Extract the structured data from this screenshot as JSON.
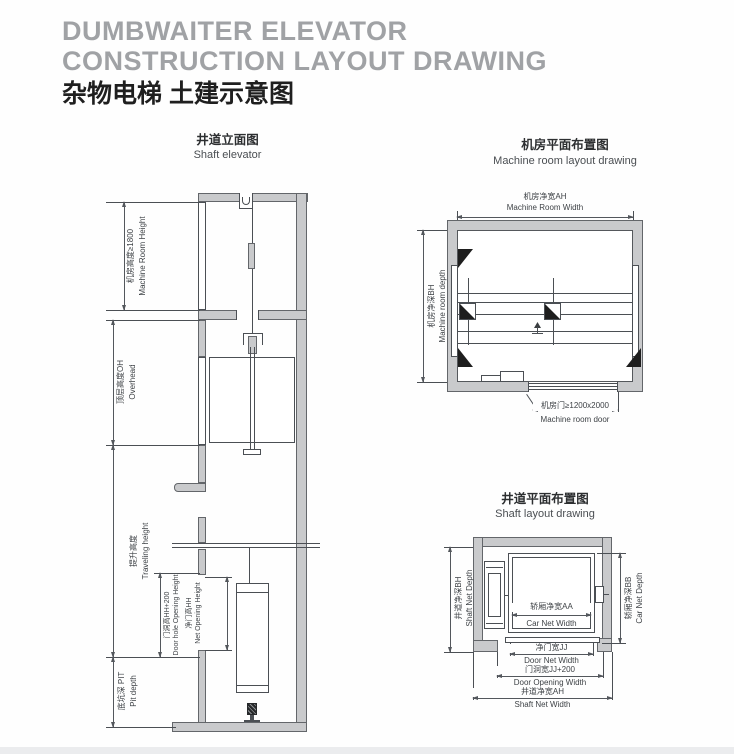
{
  "header": {
    "title_en_line1": "DUMBWAITER ELEVATOR",
    "title_en_line2": "CONSTRUCTION LAYOUT DRAWING",
    "title_cn": "杂物电梯 土建示意图"
  },
  "shaft_elevation": {
    "title_cn": "井道立面图",
    "title_en": "Shaft elevator",
    "dims": {
      "machine_room_height": {
        "cn": "机房高度≥1800",
        "en": "Machine Room Height"
      },
      "overhead": {
        "cn": "顶层高度OH",
        "en": "Overhead"
      },
      "traveling_height": {
        "cn": "提升高度",
        "en": "Traveling height"
      },
      "door_opening_height": {
        "cn": "门洞高HH+200",
        "en": "Door hole Opening Height"
      },
      "net_opening_height": {
        "cn": "净门高HH",
        "en": "Net Opening Height"
      },
      "pit_depth": {
        "cn": "底坑深 PIT",
        "en": "Pit depth"
      }
    }
  },
  "machine_room_plan": {
    "title_cn": "机房平面布置图",
    "title_en": "Machine room layout drawing",
    "dims": {
      "width": {
        "cn": "机房净宽AH",
        "en": "Machine Room Width"
      },
      "depth": {
        "cn": "机房净深BH",
        "en": "Machine room depth"
      },
      "door": {
        "cn": "机房门≥1200x2000",
        "en": "Machine room door"
      }
    }
  },
  "shaft_plan": {
    "title_cn": "井道平面布置图",
    "title_en": "Shaft layout drawing",
    "dims": {
      "shaft_net_depth": {
        "cn": "井道净深BH",
        "en": "Shaft Net Depth"
      },
      "car_net_depth": {
        "cn": "轿厢净深BB",
        "en": "Car Net Depth"
      },
      "car_net_width": {
        "cn": "轿厢净宽AA",
        "en": "Car Net Width"
      },
      "door_net_width": {
        "cn": "净门宽JJ",
        "en": "Door Net Width"
      },
      "door_opening_width": {
        "cn": "门洞宽JJ+200",
        "en": "Door Opening Width"
      },
      "shaft_net_width": {
        "cn": "井道净宽AH",
        "en": "Shaft Net Width"
      }
    }
  },
  "colors": {
    "wall_fill": "#c9cacc",
    "line": "#4b4f54",
    "dim_text": "#3e4246",
    "title_gray": "#a0a2a5",
    "title_dark": "#1f1f1f"
  }
}
